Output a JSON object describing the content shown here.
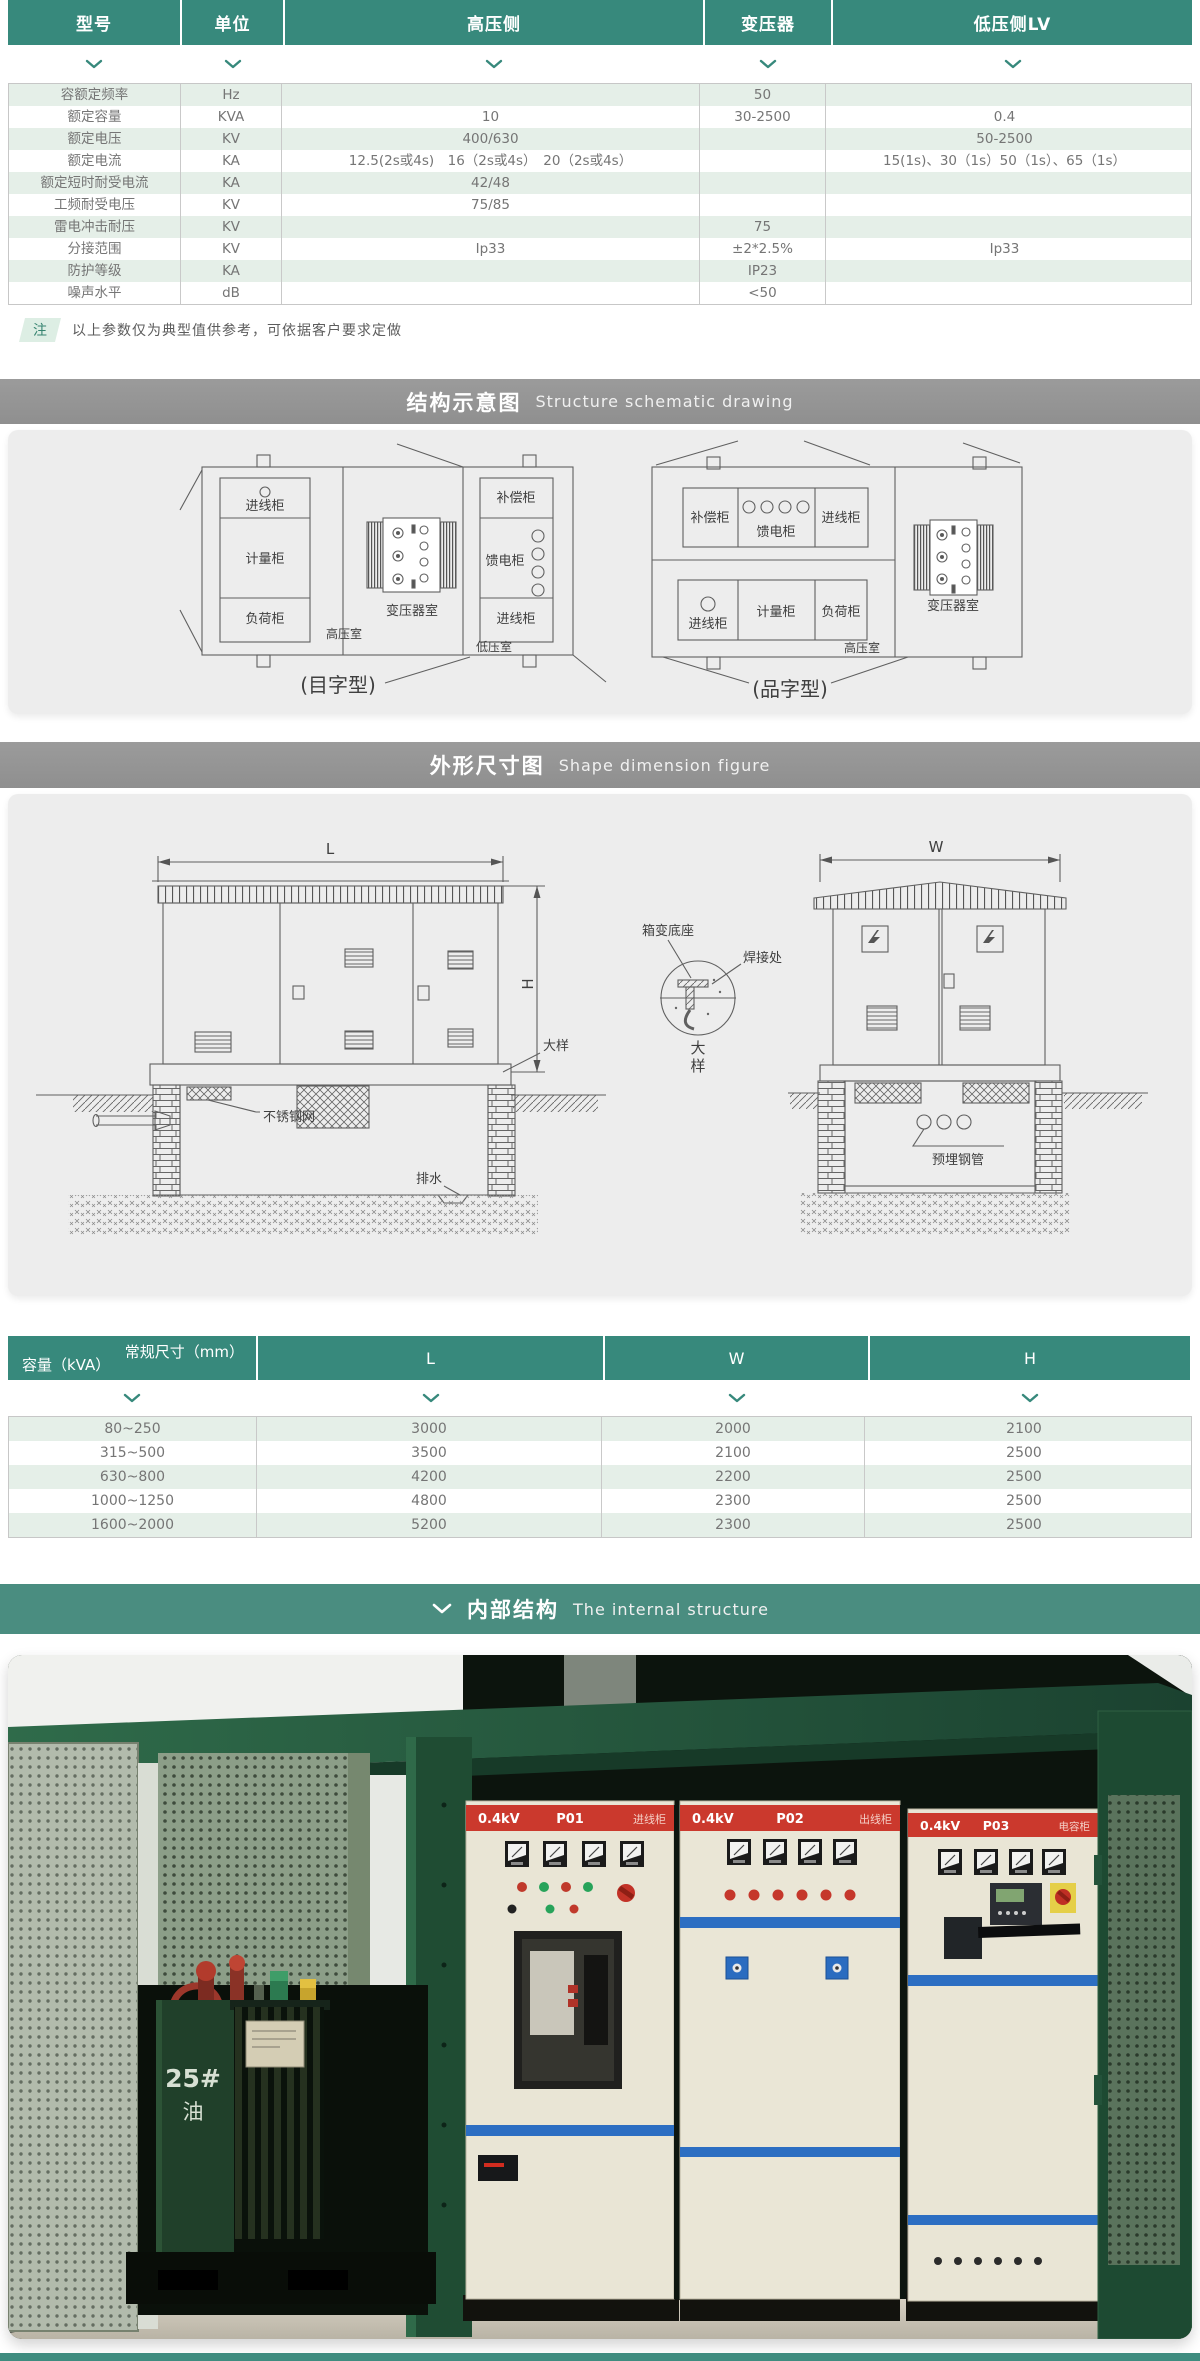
{
  "spec_table": {
    "columns": [
      "型号",
      "单位",
      "高压侧",
      "变压器",
      "低压侧LV"
    ],
    "rows": [
      {
        "param": "容额定频率",
        "unit": "Hz",
        "hv": "",
        "tx": "50",
        "lv": ""
      },
      {
        "param": "额定容量",
        "unit": "KVA",
        "hv": "10",
        "tx": "30-2500",
        "lv": "0.4"
      },
      {
        "param": "额定电压",
        "unit": "KV",
        "hv": "400/630",
        "tx": "",
        "lv": "50-2500"
      },
      {
        "param": "额定电流",
        "unit": "KA",
        "hv": "12.5(2s或4s)　16（2s或4s）　20（2s或4s）",
        "tx": "",
        "lv": "15(1s)、30（1s）50（1s）、65（1s）"
      },
      {
        "param": "额定短时耐受电流",
        "unit": "KA",
        "hv": "42/48",
        "tx": "",
        "lv": ""
      },
      {
        "param": "工频耐受电压",
        "unit": "KV",
        "hv": "75/85",
        "tx": "",
        "lv": ""
      },
      {
        "param": "雷电冲击耐压",
        "unit": "KV",
        "hv": "",
        "tx": "75",
        "lv": ""
      },
      {
        "param": "分接范围",
        "unit": "KV",
        "hv": "Ip33",
        "tx": "±2*2.5%",
        "lv": "Ip33"
      },
      {
        "param": "防护等级",
        "unit": "KA",
        "hv": "",
        "tx": "IP23",
        "lv": ""
      },
      {
        "param": "噪声水平",
        "unit": "dB",
        "hv": "",
        "tx": "<50",
        "lv": ""
      }
    ],
    "note_badge": "注",
    "note_text": "以上参数仅为典型值供参考，可依据客户要求定做"
  },
  "sections": {
    "structure": {
      "zh": "结构示意图",
      "en": "Structure schematic drawing"
    },
    "dimension": {
      "zh": "外形尺寸图",
      "en": "Shape dimension figure"
    },
    "internal": {
      "zh": "内部结构",
      "en": "The internal structure"
    }
  },
  "schematic": {
    "left": {
      "boxes_hv": [
        "进线柜",
        "计量柜",
        "负荷柜"
      ],
      "room_hv": "高压室",
      "room_tx": "变压器室",
      "boxes_lv": [
        "补偿柜",
        "馈电柜",
        "进线柜"
      ],
      "room_lv": "低压室",
      "caption": "(目字型)"
    },
    "right": {
      "boxes_top": [
        "补偿柜",
        "馈电柜",
        "进线柜"
      ],
      "boxes_bottom": [
        "进线柜",
        "计量柜",
        "负荷柜"
      ],
      "room_hv": "高压室",
      "room_tx": "变压器室",
      "caption": "(品字型)"
    }
  },
  "dimension_figure": {
    "dim_l": "L",
    "dim_w": "W",
    "dim_h": "H",
    "label_mesh": "不锈钢网",
    "label_drain": "排水",
    "label_detail": "大样",
    "label_base": "箱变底座",
    "label_weld": "焊接处",
    "detail_char_1": "大",
    "detail_char_2": "样",
    "label_pipes": "预埋钢管"
  },
  "dims_table": {
    "corner_top": "常规尺寸（mm）",
    "corner_bottom": "容量（kVA）",
    "columns": [
      "L",
      "W",
      "H"
    ],
    "rows": [
      {
        "capacity": "80~250",
        "l": "3000",
        "w": "2000",
        "h": "2100"
      },
      {
        "capacity": "315~500",
        "l": "3500",
        "w": "2100",
        "h": "2500"
      },
      {
        "capacity": "630~800",
        "l": "4200",
        "w": "2200",
        "h": "2500"
      },
      {
        "capacity": "1000~1250",
        "l": "4800",
        "w": "2300",
        "h": "2500"
      },
      {
        "capacity": "1600~2000",
        "l": "5200",
        "w": "2300",
        "h": "2500"
      }
    ]
  },
  "photo": {
    "panels": [
      {
        "kv": "0.4kV",
        "code": "P01",
        "name": "进线柜"
      },
      {
        "kv": "0.4kV",
        "code": "P02",
        "name": "出线柜"
      },
      {
        "kv": "0.4kV",
        "code": "P03",
        "name": "电容柜"
      }
    ],
    "oil_mark_line1": "25#",
    "oil_mark_line2": "油"
  },
  "colors": {
    "teal": "#37897c",
    "band_teal": "#4a8d80",
    "row_green": "#e5efe8",
    "banner_red": "#cb392d",
    "stripe_blue": "#2c6ec2"
  }
}
